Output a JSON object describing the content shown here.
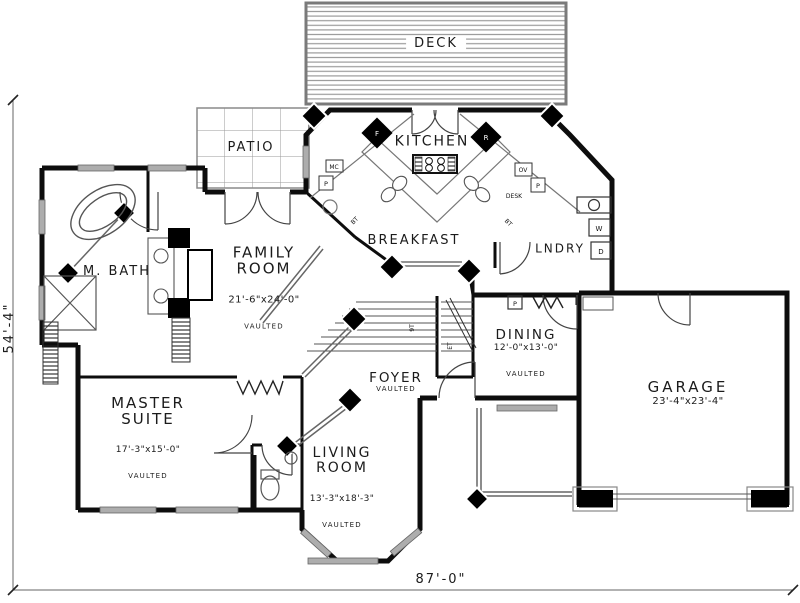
{
  "plan": {
    "dimensions": {
      "width": "87'-0\"",
      "height": "54'-4\""
    },
    "rooms": {
      "deck": {
        "name": "DECK"
      },
      "patio": {
        "name": "PATIO"
      },
      "kitchen": {
        "name": "KITCHEN"
      },
      "breakfast": {
        "name": "BREAKFAST"
      },
      "laundry": {
        "name": "LNDRY"
      },
      "dining": {
        "name": "DINING",
        "dims": "12'-0\"x13'-0\"",
        "note": "VAULTED"
      },
      "family": {
        "name": "FAMILY ROOM",
        "dims": "21'-6\"x24'-0\"",
        "note": "VAULTED"
      },
      "master_bath": {
        "name": "M. BATH"
      },
      "master": {
        "name": "MASTER SUITE",
        "dims": "17'-3\"x15'-0\"",
        "note": "VAULTED"
      },
      "foyer": {
        "name": "FOYER",
        "note": "VAULTED"
      },
      "living": {
        "name": "LIVING ROOM",
        "dims": "13'-3\"x18'-3\"",
        "note": "VAULTED"
      },
      "garage": {
        "name": "GARAGE",
        "dims": "23'-4\"x23'-4\""
      }
    },
    "fixtures": {
      "fridge": "F",
      "range": "R",
      "microwave": "MC",
      "pantry_left": "P",
      "oven": "OV",
      "pantry_right": "P",
      "desk": "DESK",
      "washer": "W",
      "dryer": "D",
      "closet_pantry": "P"
    },
    "marks": {
      "counter_left": "BT",
      "counter_right": "BT",
      "stair_up": "9T",
      "stair_dn": "ET"
    },
    "colors": {
      "wall": "#0d0d0d",
      "thin_line": "#555555",
      "window": "#adadad",
      "deck_board": "#9a9a9a"
    }
  }
}
